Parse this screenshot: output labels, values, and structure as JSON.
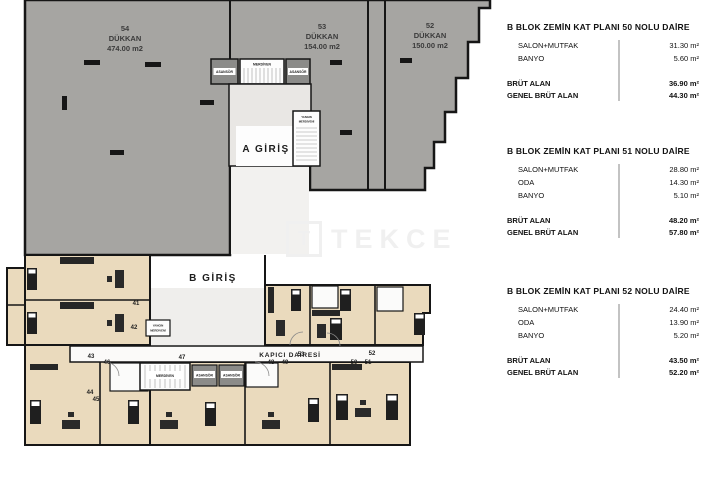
{
  "plan": {
    "shops": [
      {
        "number": "54",
        "type": "DÜKKAN",
        "area": "474.00 m2"
      },
      {
        "number": "53",
        "type": "DÜKKAN",
        "area": "154.00 m2"
      },
      {
        "number": "52",
        "type": "DÜKKAN",
        "area": "150.00 m2"
      }
    ],
    "entrance_a": "A GİRİŞ",
    "entrance_b": "B GİRİŞ",
    "kapici": "KAPICI DAİRESİ",
    "asansor": "ASANSÖR",
    "merdiven": "MERDİVEN",
    "yangin_line1": "YANGIN",
    "yangin_line2": "MERDİVENİ",
    "units": [
      "41",
      "42",
      "43",
      "44",
      "45",
      "46",
      "47",
      "48",
      "49",
      "53",
      "50",
      "51",
      "52"
    ],
    "watermark_logo": "T",
    "watermark": "TEKCE"
  },
  "panel": {
    "blocks": [
      {
        "title": "B BLOK ZEMİN KAT PLANI 50 NOLU DAİRE",
        "rows": [
          {
            "label": "SALON+MUTFAK",
            "value": "31.30 m²"
          },
          {
            "label": "BANYO",
            "value": "5.60 m²"
          }
        ],
        "totals": [
          {
            "label": "BRÜT ALAN",
            "value": "36.90 m²"
          },
          {
            "label": "GENEL BRÜT ALAN",
            "value": "44.30 m²"
          }
        ]
      },
      {
        "title": "B BLOK ZEMİN KAT PLANI 51 NOLU DAİRE",
        "rows": [
          {
            "label": "SALON+MUTFAK",
            "value": "28.80 m²"
          },
          {
            "label": "ODA",
            "value": "14.30 m²"
          },
          {
            "label": "BANYO",
            "value": "5.10 m²"
          }
        ],
        "totals": [
          {
            "label": "BRÜT ALAN",
            "value": "48.20 m²"
          },
          {
            "label": "GENEL BRÜT ALAN",
            "value": "57.80 m²"
          }
        ]
      },
      {
        "title": "B BLOK ZEMİN KAT PLANI 52 NOLU DAİRE",
        "rows": [
          {
            "label": "SALON+MUTFAK",
            "value": "24.40 m²"
          },
          {
            "label": "ODA",
            "value": "13.90 m²"
          },
          {
            "label": "BANYO",
            "value": "5.20 m²"
          }
        ],
        "totals": [
          {
            "label": "BRÜT ALAN",
            "value": "43.50 m²"
          },
          {
            "label": "GENEL BRÜT ALAN",
            "value": "52.20 m²"
          }
        ]
      }
    ]
  },
  "colors": {
    "shop_fill": "#a6a5a2",
    "apartment_fill": "#eadabd",
    "wall": "#161616",
    "panel_divider": "#c3c3c3"
  }
}
